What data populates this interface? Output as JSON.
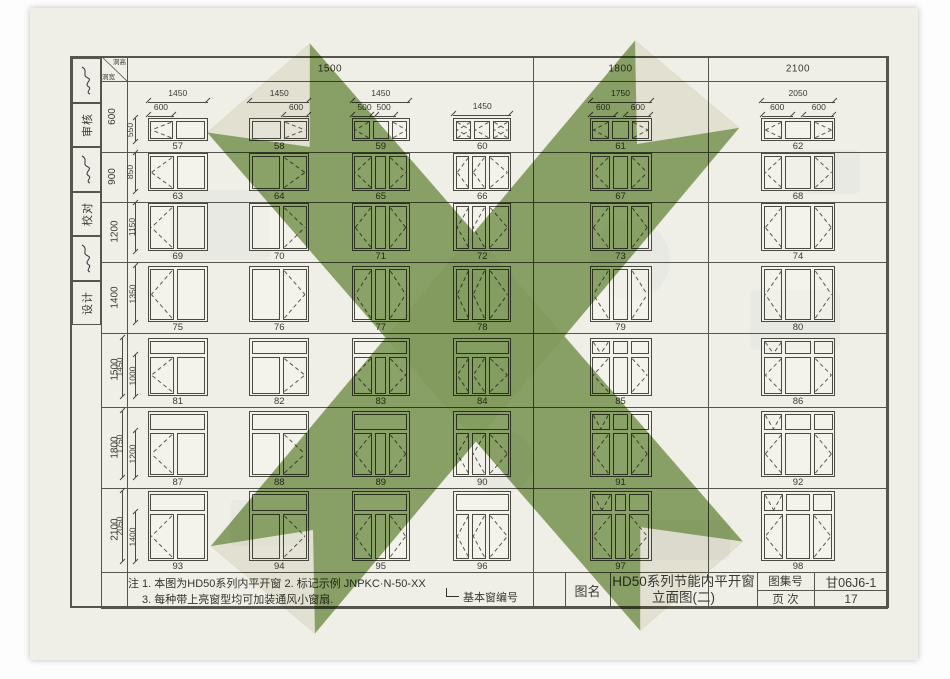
{
  "doc": {
    "type": "scanned architectural standard drawing page",
    "green_stamp_color": "#8ba568",
    "paper_color": "#f0efe7",
    "line_color": "#4a4a42"
  },
  "corner": {
    "top_right": "洞高",
    "bottom_left": "洞宽"
  },
  "sidebar": {
    "items": [
      {
        "type": "signature"
      },
      {
        "type": "label",
        "text": "审核"
      },
      {
        "type": "signature"
      },
      {
        "type": "label",
        "text": "校对"
      },
      {
        "type": "signature"
      },
      {
        "type": "label",
        "text": "设计"
      }
    ]
  },
  "col_groups": [
    {
      "label": "1500",
      "span": 4
    },
    {
      "label": "1800",
      "span": 1
    },
    {
      "label": "2100",
      "span": 1
    }
  ],
  "rows": [
    {
      "label": "600",
      "side_dims": [
        "550"
      ]
    },
    {
      "label": "900",
      "side_dims": [
        "850"
      ]
    },
    {
      "label": "1200",
      "side_dims": [
        "1150"
      ]
    },
    {
      "label": "1400",
      "side_dims": [
        "1350"
      ]
    },
    {
      "label": "1500",
      "side_dims": [
        "1450",
        "1000"
      ]
    },
    {
      "label": "1800",
      "side_dims": [
        "1750",
        "1200"
      ]
    },
    {
      "label": "2100",
      "side_dims": [
        "2050",
        "1400"
      ]
    }
  ],
  "windows": [
    {
      "n": "57",
      "r": 0,
      "c": 0,
      "td": "1450",
      "sd": [
        [
          "600",
          "l"
        ]
      ],
      "t": null,
      "p": [
        [
          "l",
          0.75
        ],
        [
          "n",
          1
        ]
      ]
    },
    {
      "n": "58",
      "r": 0,
      "c": 1,
      "td": "1450",
      "sd": [
        [
          "600",
          "r"
        ]
      ],
      "t": null,
      "p": [
        [
          "n",
          1
        ],
        [
          "r",
          0.75
        ]
      ]
    },
    {
      "n": "59",
      "r": 0,
      "c": 2,
      "td": "1450",
      "sd": [
        [
          "500",
          "l"
        ],
        [
          "500",
          "m"
        ]
      ],
      "t": null,
      "p": [
        [
          "l",
          1
        ],
        [
          "n",
          1
        ],
        [
          "r",
          1
        ]
      ]
    },
    {
      "n": "60",
      "r": 0,
      "c": 3,
      "td": "1450",
      "sd": [],
      "t": null,
      "p": [
        [
          "x",
          1
        ],
        [
          "l",
          1
        ],
        [
          "x",
          1
        ]
      ]
    },
    {
      "n": "61",
      "r": 0,
      "c": 4,
      "td": "1750",
      "sd": [
        [
          "600",
          "l"
        ],
        [
          "600",
          "r"
        ]
      ],
      "t": null,
      "p": [
        [
          "l",
          1
        ],
        [
          "n",
          0.92
        ],
        [
          "r",
          1
        ]
      ]
    },
    {
      "n": "62",
      "r": 0,
      "c": 5,
      "td": "2050",
      "sd": [
        [
          "600",
          "l"
        ],
        [
          "600",
          "r"
        ]
      ],
      "t": null,
      "p": [
        [
          "l",
          1
        ],
        [
          "n",
          1.4
        ],
        [
          "r",
          1
        ]
      ]
    },
    {
      "n": "63",
      "r": 1,
      "c": 0,
      "t": null,
      "p": [
        [
          "l",
          0.8
        ],
        [
          "n",
          1
        ]
      ]
    },
    {
      "n": "64",
      "r": 1,
      "c": 1,
      "t": null,
      "p": [
        [
          "n",
          1
        ],
        [
          "r",
          0.8
        ]
      ]
    },
    {
      "n": "65",
      "r": 1,
      "c": 2,
      "t": null,
      "p": [
        [
          "l",
          1
        ],
        [
          "n",
          0.55
        ],
        [
          "r",
          1
        ]
      ]
    },
    {
      "n": "66",
      "r": 1,
      "c": 3,
      "t": null,
      "p": [
        [
          "l",
          0.85
        ],
        [
          "l",
          0.85
        ],
        [
          "r",
          1.3
        ]
      ]
    },
    {
      "n": "67",
      "r": 1,
      "c": 4,
      "t": null,
      "p": [
        [
          "l",
          1
        ],
        [
          "n",
          0.9
        ],
        [
          "r",
          1
        ]
      ]
    },
    {
      "n": "68",
      "r": 1,
      "c": 5,
      "t": null,
      "p": [
        [
          "l",
          1
        ],
        [
          "n",
          1.4
        ],
        [
          "r",
          1
        ]
      ]
    },
    {
      "n": "69",
      "r": 2,
      "c": 0,
      "t": null,
      "p": [
        [
          "l",
          0.8
        ],
        [
          "n",
          1
        ]
      ]
    },
    {
      "n": "70",
      "r": 2,
      "c": 1,
      "t": null,
      "p": [
        [
          "n",
          1
        ],
        [
          "r",
          0.8
        ]
      ]
    },
    {
      "n": "71",
      "r": 2,
      "c": 2,
      "t": null,
      "p": [
        [
          "l",
          1
        ],
        [
          "n",
          0.55
        ],
        [
          "r",
          1
        ]
      ]
    },
    {
      "n": "72",
      "r": 2,
      "c": 3,
      "t": null,
      "p": [
        [
          "l",
          0.85
        ],
        [
          "l",
          0.85
        ],
        [
          "r",
          1.3
        ]
      ]
    },
    {
      "n": "73",
      "r": 2,
      "c": 4,
      "t": null,
      "p": [
        [
          "l",
          1
        ],
        [
          "n",
          0.9
        ],
        [
          "r",
          1
        ]
      ]
    },
    {
      "n": "74",
      "r": 2,
      "c": 5,
      "t": null,
      "p": [
        [
          "l",
          1
        ],
        [
          "n",
          1.4
        ],
        [
          "r",
          1
        ]
      ]
    },
    {
      "n": "75",
      "r": 3,
      "c": 0,
      "t": null,
      "p": [
        [
          "l",
          0.8
        ],
        [
          "n",
          1
        ]
      ]
    },
    {
      "n": "76",
      "r": 3,
      "c": 1,
      "t": null,
      "p": [
        [
          "n",
          1
        ],
        [
          "r",
          0.8
        ]
      ]
    },
    {
      "n": "77",
      "r": 3,
      "c": 2,
      "t": null,
      "p": [
        [
          "l",
          1
        ],
        [
          "n",
          0.55
        ],
        [
          "r",
          1
        ]
      ]
    },
    {
      "n": "78",
      "r": 3,
      "c": 3,
      "t": null,
      "p": [
        [
          "l",
          0.85
        ],
        [
          "l",
          0.85
        ],
        [
          "r",
          1.3
        ]
      ]
    },
    {
      "n": "79",
      "r": 3,
      "c": 4,
      "t": null,
      "p": [
        [
          "l",
          1
        ],
        [
          "n",
          0.9
        ],
        [
          "r",
          1
        ]
      ]
    },
    {
      "n": "80",
      "r": 3,
      "c": 5,
      "t": null,
      "p": [
        [
          "l",
          1
        ],
        [
          "n",
          1.4
        ],
        [
          "r",
          1
        ]
      ]
    },
    {
      "n": "81",
      "r": 4,
      "c": 0,
      "t": [
        [
          "n",
          1
        ]
      ],
      "p": [
        [
          "l",
          0.8
        ],
        [
          "n",
          1
        ]
      ]
    },
    {
      "n": "82",
      "r": 4,
      "c": 1,
      "t": [
        [
          "n",
          1
        ]
      ],
      "p": [
        [
          "n",
          1
        ],
        [
          "r",
          0.8
        ]
      ]
    },
    {
      "n": "83",
      "r": 4,
      "c": 2,
      "t": [
        [
          "n",
          1
        ]
      ],
      "p": [
        [
          "l",
          1
        ],
        [
          "n",
          0.55
        ],
        [
          "r",
          1
        ]
      ]
    },
    {
      "n": "84",
      "r": 4,
      "c": 3,
      "t": [
        [
          "n",
          1
        ]
      ],
      "p": [
        [
          "l",
          0.85
        ],
        [
          "l",
          0.85
        ],
        [
          "r",
          1.3
        ]
      ]
    },
    {
      "n": "85",
      "r": 4,
      "c": 4,
      "t": [
        [
          "v",
          1
        ],
        [
          "n",
          0.9
        ],
        [
          "n",
          1
        ]
      ],
      "p": [
        [
          "l",
          1
        ],
        [
          "n",
          0.9
        ],
        [
          "r",
          1
        ]
      ]
    },
    {
      "n": "86",
      "r": 4,
      "c": 5,
      "t": [
        [
          "v",
          1
        ],
        [
          "n",
          1.4
        ],
        [
          "n",
          1
        ]
      ],
      "p": [
        [
          "l",
          1
        ],
        [
          "n",
          1.4
        ],
        [
          "r",
          1
        ]
      ]
    },
    {
      "n": "87",
      "r": 5,
      "c": 0,
      "t": [
        [
          "n",
          1
        ]
      ],
      "p": [
        [
          "l",
          0.8
        ],
        [
          "n",
          1
        ]
      ]
    },
    {
      "n": "88",
      "r": 5,
      "c": 1,
      "t": [
        [
          "n",
          1
        ]
      ],
      "p": [
        [
          "n",
          1
        ],
        [
          "r",
          0.8
        ]
      ]
    },
    {
      "n": "89",
      "r": 5,
      "c": 2,
      "t": [
        [
          "n",
          1
        ]
      ],
      "p": [
        [
          "l",
          1
        ],
        [
          "n",
          0.55
        ],
        [
          "r",
          1
        ]
      ]
    },
    {
      "n": "90",
      "r": 5,
      "c": 3,
      "t": [
        [
          "n",
          1
        ]
      ],
      "p": [
        [
          "l",
          0.85
        ],
        [
          "l",
          0.85
        ],
        [
          "r",
          1.3
        ]
      ]
    },
    {
      "n": "91",
      "r": 5,
      "c": 4,
      "t": [
        [
          "v",
          1
        ],
        [
          "n",
          0.9
        ],
        [
          "n",
          1
        ]
      ],
      "p": [
        [
          "l",
          1
        ],
        [
          "n",
          0.9
        ],
        [
          "r",
          1
        ]
      ]
    },
    {
      "n": "92",
      "r": 5,
      "c": 5,
      "t": [
        [
          "v",
          1
        ],
        [
          "n",
          1.4
        ],
        [
          "n",
          1
        ]
      ],
      "p": [
        [
          "l",
          1
        ],
        [
          "n",
          1.4
        ],
        [
          "r",
          1
        ]
      ]
    },
    {
      "n": "93",
      "r": 6,
      "c": 0,
      "t": [
        [
          "n",
          1
        ]
      ],
      "p": [
        [
          "l",
          0.8
        ],
        [
          "n",
          1
        ]
      ]
    },
    {
      "n": "94",
      "r": 6,
      "c": 1,
      "t": [
        [
          "n",
          1
        ]
      ],
      "p": [
        [
          "n",
          1
        ],
        [
          "r",
          0.8
        ]
      ]
    },
    {
      "n": "95",
      "r": 6,
      "c": 2,
      "t": [
        [
          "n",
          1
        ]
      ],
      "p": [
        [
          "l",
          1
        ],
        [
          "n",
          0.55
        ],
        [
          "r",
          1
        ]
      ]
    },
    {
      "n": "96",
      "r": 6,
      "c": 3,
      "t": [
        [
          "n",
          1
        ]
      ],
      "p": [
        [
          "l",
          0.85
        ],
        [
          "l",
          0.85
        ],
        [
          "r",
          1.3
        ]
      ]
    },
    {
      "n": "97",
      "r": 6,
      "c": 4,
      "t": [
        [
          "v",
          1
        ],
        [
          "n",
          0.55
        ],
        [
          "n",
          1
        ]
      ],
      "p": [
        [
          "l",
          1
        ],
        [
          "n",
          0.55
        ],
        [
          "r",
          1
        ]
      ]
    },
    {
      "n": "98",
      "r": 6,
      "c": 5,
      "t": [
        [
          "v",
          1
        ],
        [
          "n",
          1.3
        ],
        [
          "n",
          1
        ]
      ],
      "p": [
        [
          "l",
          1
        ],
        [
          "n",
          1.3
        ],
        [
          "r",
          1
        ]
      ]
    }
  ],
  "notes": {
    "line1": "注 1. 本图为HD50系列内平开窗  2. 标记示例 JNPKC·N-50-XX",
    "line2": "3. 每种带上亮窗型均可加装通风小窗扇.",
    "callout": "基本窗编号"
  },
  "titleblock": {
    "name_label": "图名",
    "name_line1": "HD50系列节能内平开窗",
    "name_line2": "立面图(二)",
    "atlas_label": "图集号",
    "atlas_value": "甘06J6-1",
    "page_label": "页 次",
    "page_value": "17"
  }
}
